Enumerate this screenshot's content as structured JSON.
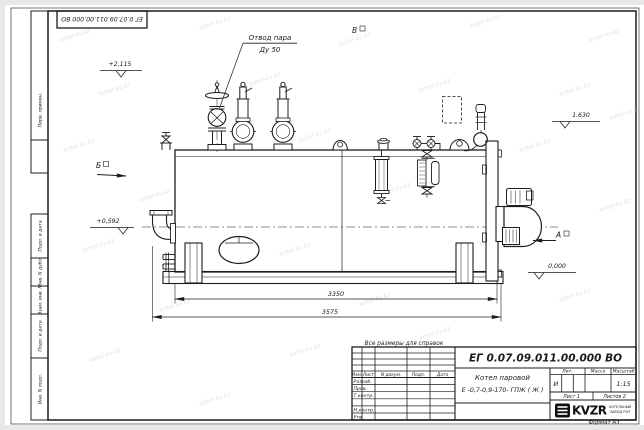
{
  "watermark": {
    "text": "kotel-kv.kz"
  },
  "frame": {
    "top_left_code": "ЕГ 0.07.09.011.00.000 ВО",
    "format_note": "Формат А3",
    "left_column_labels": [
      "Перв. примен.",
      "Подп. и дата",
      "Инв. N дубл.",
      "Взам. инв. N",
      "Подп. и дата",
      "Инв. N подл."
    ]
  },
  "drawing": {
    "callout": {
      "line1": "Отвод пара",
      "line2": "Ду 50"
    },
    "views": {
      "a": "А",
      "b": "Б",
      "v": "В"
    },
    "elevations": {
      "top": "+2,115",
      "chimney": "1.630",
      "middle": "+0,592",
      "ground": "0,000"
    },
    "dimensions": {
      "inner": "3350",
      "overall": "3575"
    }
  },
  "title_block": {
    "note": "Все размеры для справок",
    "doc_number": "ЕГ 0.07.09.011.00.000  ВО",
    "product_line1": "Котел паровой",
    "product_line2": "Е -0,7-0,9-170- ГПЖ ( Ж )",
    "columns": [
      "Изм.",
      "Лист",
      "N докум.",
      "Подп.",
      "Дата"
    ],
    "roles": [
      "Разраб.",
      "Пров.",
      "Т.контр.",
      "Н.контр.",
      "Утв."
    ],
    "lit_header": "Лит.",
    "mass_header": "Масса",
    "scale_header": "Масштаб",
    "lit_value": "И",
    "scale_value": "1:15",
    "sheet": "Лист 1",
    "sheets": "Листов 2",
    "logo": "KVZR",
    "logo_sub1": "КОТЕЛЬНЫЙ",
    "logo_sub2": "ЗАВОД РЭП"
  }
}
